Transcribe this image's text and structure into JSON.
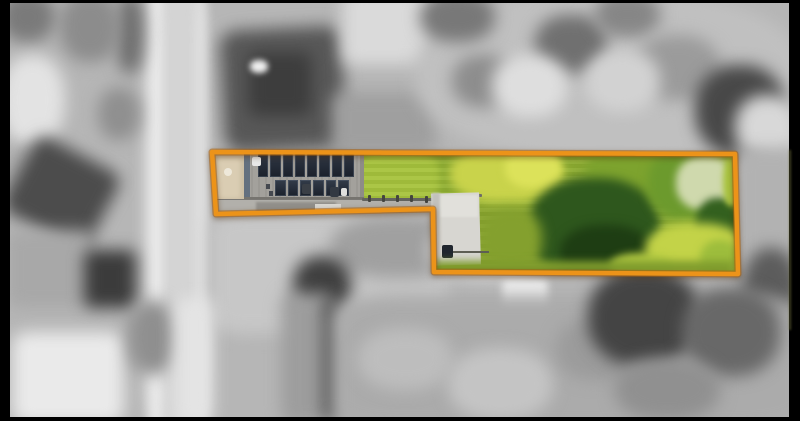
{
  "photo": {
    "alt": "Aerial drone photograph of a long narrow residential lot outlined in orange; the lot is shown in colour with a solar-panelled roof, driveway, lawn and mature trees, while the surrounding neighbourhood is blurred greyscale"
  },
  "property_highlight": {
    "border_color": "#EC9319",
    "border_shadow_color": "#A96310",
    "border_width": 4.5,
    "polygon_points": [
      [
        212,
        152
      ],
      [
        735,
        154
      ],
      [
        738,
        274
      ],
      [
        434,
        272
      ],
      [
        433,
        209
      ],
      [
        216,
        214
      ]
    ]
  },
  "building": {
    "solar_panel_rows": [
      8,
      6
    ]
  },
  "palette": {
    "lawn_green": "#8FAE33",
    "tree_dark_green": "#2E571D",
    "tree_yellow_green": "#C9D34B",
    "driveway_tan": "#CDBFA5",
    "letterbox_black": "#000000"
  }
}
